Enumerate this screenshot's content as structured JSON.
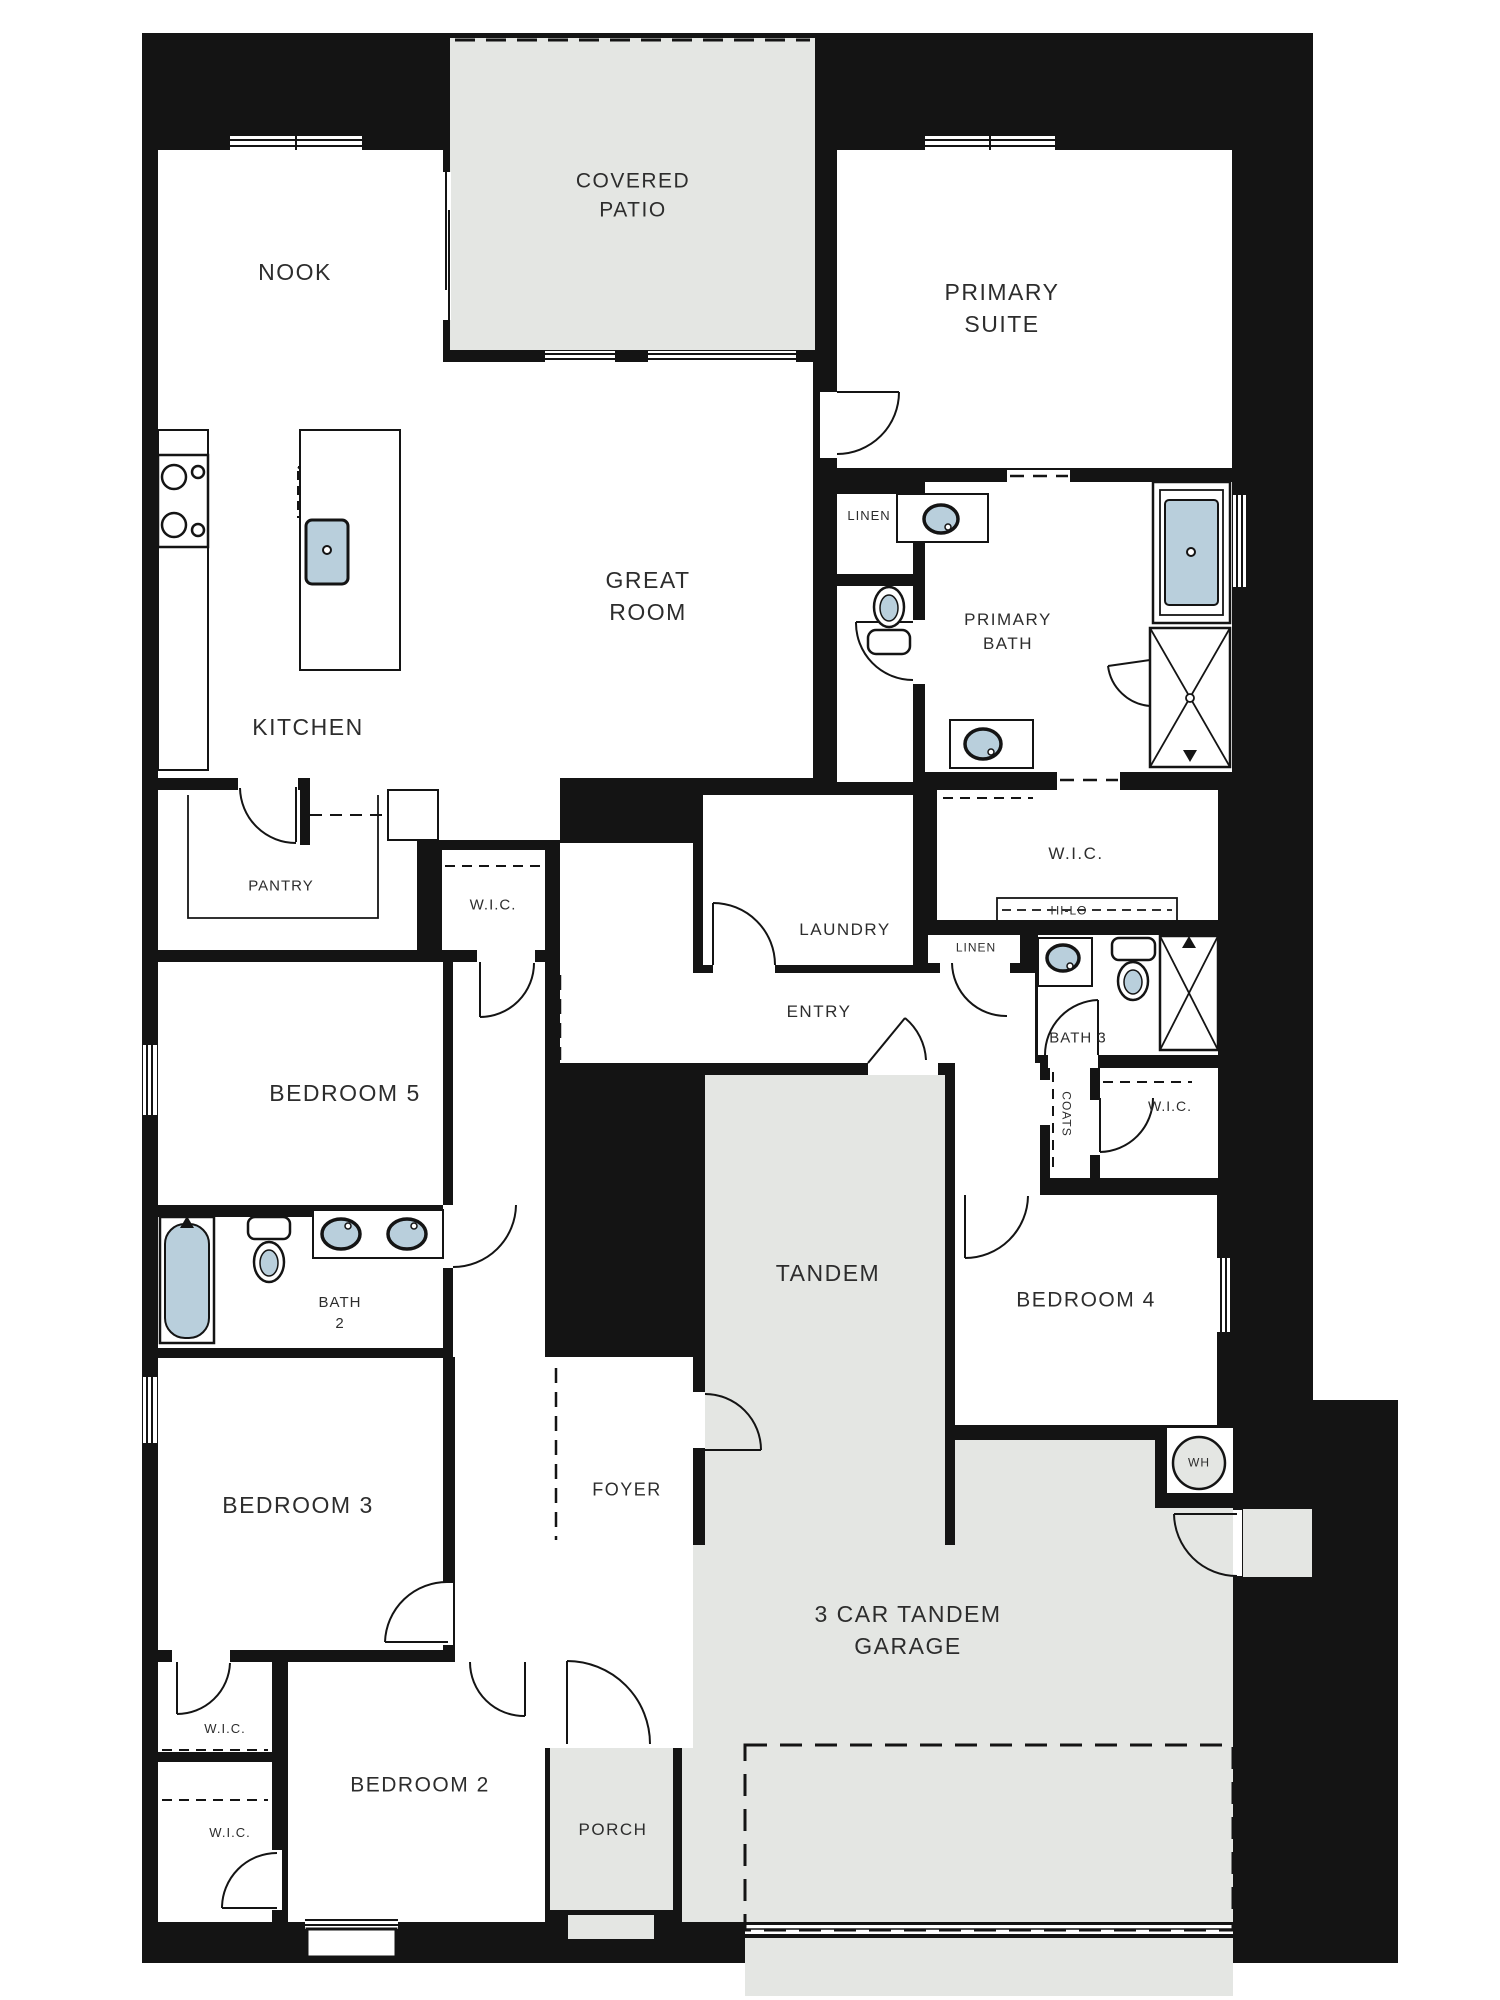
{
  "colors": {
    "page_background": "#ffffff",
    "wall": "#141414",
    "outdoor_area": "#e4e6e3",
    "water_fixture": "#b9cfdc",
    "label_text": "#2d2d2d"
  },
  "rooms": {
    "covered_patio": {
      "line1": "COVERED",
      "line2": "PATIO"
    },
    "nook": {
      "label": "NOOK"
    },
    "primary_suite": {
      "line1": "PRIMARY",
      "line2": "SUITE"
    },
    "great_room": {
      "line1": "GREAT",
      "line2": "ROOM"
    },
    "kitchen": {
      "label": "KITCHEN"
    },
    "pantry": {
      "label": "PANTRY"
    },
    "linen_upper": {
      "label": "LINEN"
    },
    "primary_bath": {
      "line1": "PRIMARY",
      "line2": "BATH"
    },
    "wic_hall": {
      "label": "W.I.C."
    },
    "laundry": {
      "label": "LAUNDRY"
    },
    "entry": {
      "label": "ENTRY"
    },
    "wic_primary": {
      "label": "W.I.C."
    },
    "hi_lo": {
      "label": "HI-LO"
    },
    "linen_lower": {
      "label": "LINEN"
    },
    "bath_3": {
      "label": "BATH 3"
    },
    "coats": {
      "label": "COATS"
    },
    "wic_3": {
      "label": "W.I.C."
    },
    "bedroom_5": {
      "label": "BEDROOM 5"
    },
    "bath_2": {
      "line1": "BATH",
      "line2": "2"
    },
    "tandem": {
      "label": "TANDEM"
    },
    "bedroom_4": {
      "label": "BEDROOM 4"
    },
    "bedroom_3": {
      "label": "BEDROOM 3"
    },
    "foyer": {
      "label": "FOYER"
    },
    "water_heater": {
      "label": "WH"
    },
    "garage": {
      "line1": "3 CAR TANDEM",
      "line2": "GARAGE"
    },
    "wic_2a": {
      "label": "W.I.C."
    },
    "bedroom_2": {
      "label": "BEDROOM 2"
    },
    "wic_2b": {
      "label": "W.I.C."
    },
    "porch": {
      "label": "PORCH"
    }
  },
  "fixtures": [
    "cooktop",
    "kitchen-island-sink",
    "refrigerator",
    "primary-bath-sink",
    "primary-bath-vanity-sink",
    "primary-bathtub",
    "primary-walk-in-shower",
    "primary-toilet",
    "bath3-sink",
    "bath3-toilet",
    "bath3-shower",
    "bath2-tub",
    "bath2-toilet",
    "bath2-double-sinks",
    "water-heater"
  ]
}
